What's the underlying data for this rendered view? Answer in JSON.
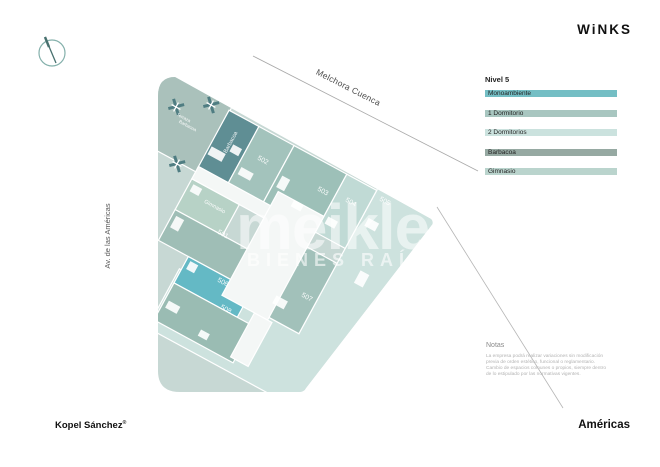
{
  "header": {
    "logo": "WiNKS"
  },
  "footer": {
    "developer": "Kopel Sánchez",
    "developer_mark": "®",
    "project": "Américas"
  },
  "streets": {
    "top": "Melchora Cuenca",
    "left": "Av. de las Américas"
  },
  "legend": {
    "title": "Nivel 5",
    "items": [
      {
        "label": "Monoambiente",
        "color": "#74bec4"
      },
      {
        "label": "1 Dormitorio",
        "color": "#a8c6c0"
      },
      {
        "label": "2 Dormitorios",
        "color": "#cbe2de"
      },
      {
        "label": "Barbacoa",
        "color": "#96a9a2"
      },
      {
        "label": "Gimnasio",
        "color": "#bad4cd"
      }
    ]
  },
  "notes": {
    "title": "Notas",
    "lines": [
      "La empresa podrá realizar variaciones sin modificación",
      "previa de orden estético, funcional o reglamentario.",
      "Cambio de espacios comunes o propios, siempre dentro",
      "de lo estipulado por las normativas vigentes."
    ]
  },
  "watermark": {
    "line1": "meikle",
    "line2": "BIENES RAÍCES"
  },
  "plan": {
    "units": [
      {
        "id": "501",
        "label": "501"
      },
      {
        "id": "502",
        "label": "502"
      },
      {
        "id": "503",
        "label": "503"
      },
      {
        "id": "504",
        "label": "504"
      },
      {
        "id": "505",
        "label": "505"
      },
      {
        "id": "506",
        "label": "506"
      },
      {
        "id": "507",
        "label": "507"
      },
      {
        "id": "508",
        "label": "508"
      }
    ],
    "areas": {
      "barbacoa": "Barbacoa",
      "gimnasio": "Gimnasio",
      "terraza_line1": "Terraza",
      "terraza_line2": "Barbacoa"
    }
  },
  "colors": {
    "site_base": "#c7d8d4",
    "terrace": "#aac1bb",
    "barbacoa": "#5f8e94",
    "u501": "#9fbeb6",
    "u502": "#a3c3bc",
    "u503": "#9dc0b8",
    "u504": "#c0dad5",
    "u505": "#cde2de",
    "u506": "#64b9c5",
    "u507": "#a2c1ba",
    "u508": "#9abcb3",
    "gimnasio": "#b7d2c6",
    "core": "#f4f7f6"
  }
}
